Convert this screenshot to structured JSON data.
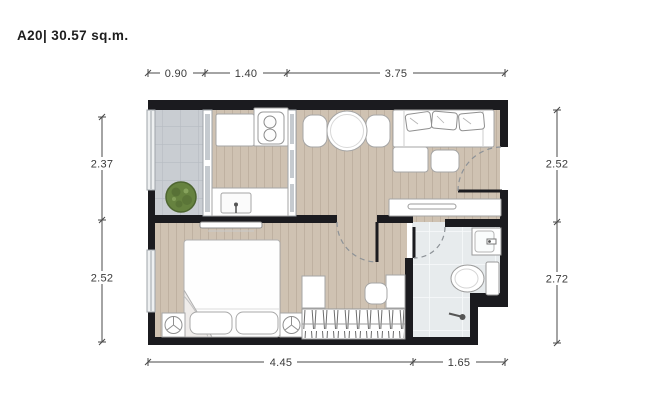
{
  "title": "A20| 30.57 sq.m.",
  "dimensions": {
    "top": [
      "0.90",
      "1.40",
      "3.75"
    ],
    "bottom": [
      "4.45",
      "1.65"
    ],
    "left": [
      "2.37",
      "2.52"
    ],
    "right": [
      "2.52",
      "2.72"
    ]
  },
  "rooms": {
    "balcony_feature": "plant",
    "kitchen_features": [
      "cabinet",
      "stove-2-burners",
      "sink"
    ],
    "living_features": [
      "round-dining-table",
      "two-chairs",
      "sofa-3-pillows",
      "ottoman",
      "side-table",
      "console"
    ],
    "bedroom_features": [
      "double-bed",
      "two-pillows",
      "nightstand-lamps",
      "tv-shelf",
      "wardrobe-hangers",
      "desk",
      "chair"
    ],
    "bathroom_features": [
      "basin",
      "toilet",
      "shower"
    ]
  },
  "colors": {
    "wall": "#1b1b1f",
    "wood-floor": "#cfc2b2",
    "wood-line": "#bfb1a1",
    "balcony-tile": "#c9cdd2",
    "balcony-grout": "#b6bbc2",
    "bath-tile": "#e7ebed",
    "bath-grout": "#f8fafb",
    "furn-fill": "#ffffff",
    "furn-stroke": "#a5a5a5",
    "plant-green": "#66823f",
    "plant-dark": "#4d6530",
    "glass": "#c5cacf",
    "dim-line": "#4a4a4a",
    "dim-text": "#3a3a3a",
    "door-arc": "#8d9297"
  }
}
